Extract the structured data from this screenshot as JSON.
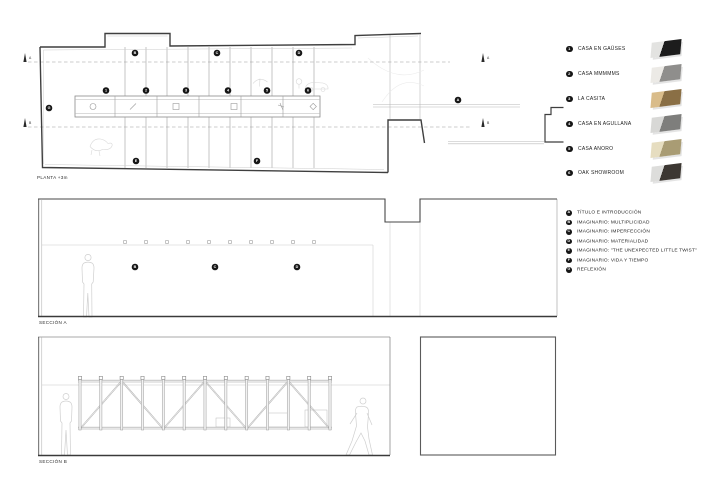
{
  "titles": {
    "plan": "PLANTA +3m",
    "section_a": "SECCIÓN A",
    "section_b": "SECCIÓN B"
  },
  "projects_legend": [
    {
      "num": "1",
      "label": "CASA EN GAÜSES",
      "thumb_light": "#e3e3e1",
      "thumb_dark": "#1c1c1c"
    },
    {
      "num": "2",
      "label": "CASA MMMMMS",
      "thumb_light": "#eceae6",
      "thumb_dark": "#8f8e8c"
    },
    {
      "num": "3",
      "label": "LA CASITA",
      "thumb_light": "#d9bc8a",
      "thumb_dark": "#8a6f45"
    },
    {
      "num": "4",
      "label": "CASA EN AGULLANA",
      "thumb_light": "#d8d8d6",
      "thumb_dark": "#7e7e7c"
    },
    {
      "num": "5",
      "label": "CASA ANORO",
      "thumb_light": "#e6ddc0",
      "thumb_dark": "#a99c74"
    },
    {
      "num": "6",
      "label": "OAK SHOWROOM",
      "thumb_light": "#dddddb",
      "thumb_dark": "#3c3732"
    }
  ],
  "chapters_legend": [
    {
      "num": "A",
      "label": "TÍTULO E INTRODUCCIÓN"
    },
    {
      "num": "B",
      "label": "IMAGINARIO: MULTIPLICIDAD"
    },
    {
      "num": "C",
      "label": "IMAGINARIO: IMPERFECCIÓN"
    },
    {
      "num": "D",
      "label": "IMAGINARIO: MATERIALIDAD"
    },
    {
      "num": "E",
      "label": "IMAGINARIO: \"THE UNEXPECTED LITTLE TWIST\""
    },
    {
      "num": "F",
      "label": "IMAGINARIO: VIDA Y TIEMPO"
    },
    {
      "num": "G",
      "label": "REFLEXIÓN"
    }
  ],
  "plan": {
    "spine_markers": [
      {
        "label": "1",
        "x": 106
      },
      {
        "label": "2",
        "x": 146
      },
      {
        "label": "3",
        "x": 186
      },
      {
        "label": "4",
        "x": 228
      },
      {
        "label": "5",
        "x": 267
      },
      {
        "label": "6",
        "x": 308
      }
    ],
    "wall_markers": [
      {
        "label": "B",
        "x": 135,
        "y": 53
      },
      {
        "label": "C",
        "x": 217,
        "y": 53
      },
      {
        "label": "D",
        "x": 299,
        "y": 53
      },
      {
        "label": "G",
        "x": 49,
        "y": 108
      },
      {
        "label": "E",
        "x": 136,
        "y": 161
      },
      {
        "label": "F",
        "x": 257,
        "y": 161
      },
      {
        "label": "A",
        "x": 458,
        "y": 100
      }
    ],
    "cut_marks": [
      {
        "label": "A",
        "x": 25,
        "y": 62
      },
      {
        "label": "A",
        "x": 483,
        "y": 62
      },
      {
        "label": "B",
        "x": 25,
        "y": 127
      },
      {
        "label": "B",
        "x": 483,
        "y": 127
      }
    ]
  },
  "section_a": {
    "marker_y": 267,
    "markers": [
      {
        "label": "B",
        "x": 135
      },
      {
        "label": "C",
        "x": 215
      },
      {
        "label": "D",
        "x": 297
      }
    ]
  },
  "colors": {
    "wall": "#3f3f3f",
    "thin": "#c4c4c4",
    "grid": "#c6c6c6",
    "marker_bg": "#161616",
    "marker_text": "#ffffff",
    "sketch": "#d6d6d6"
  }
}
